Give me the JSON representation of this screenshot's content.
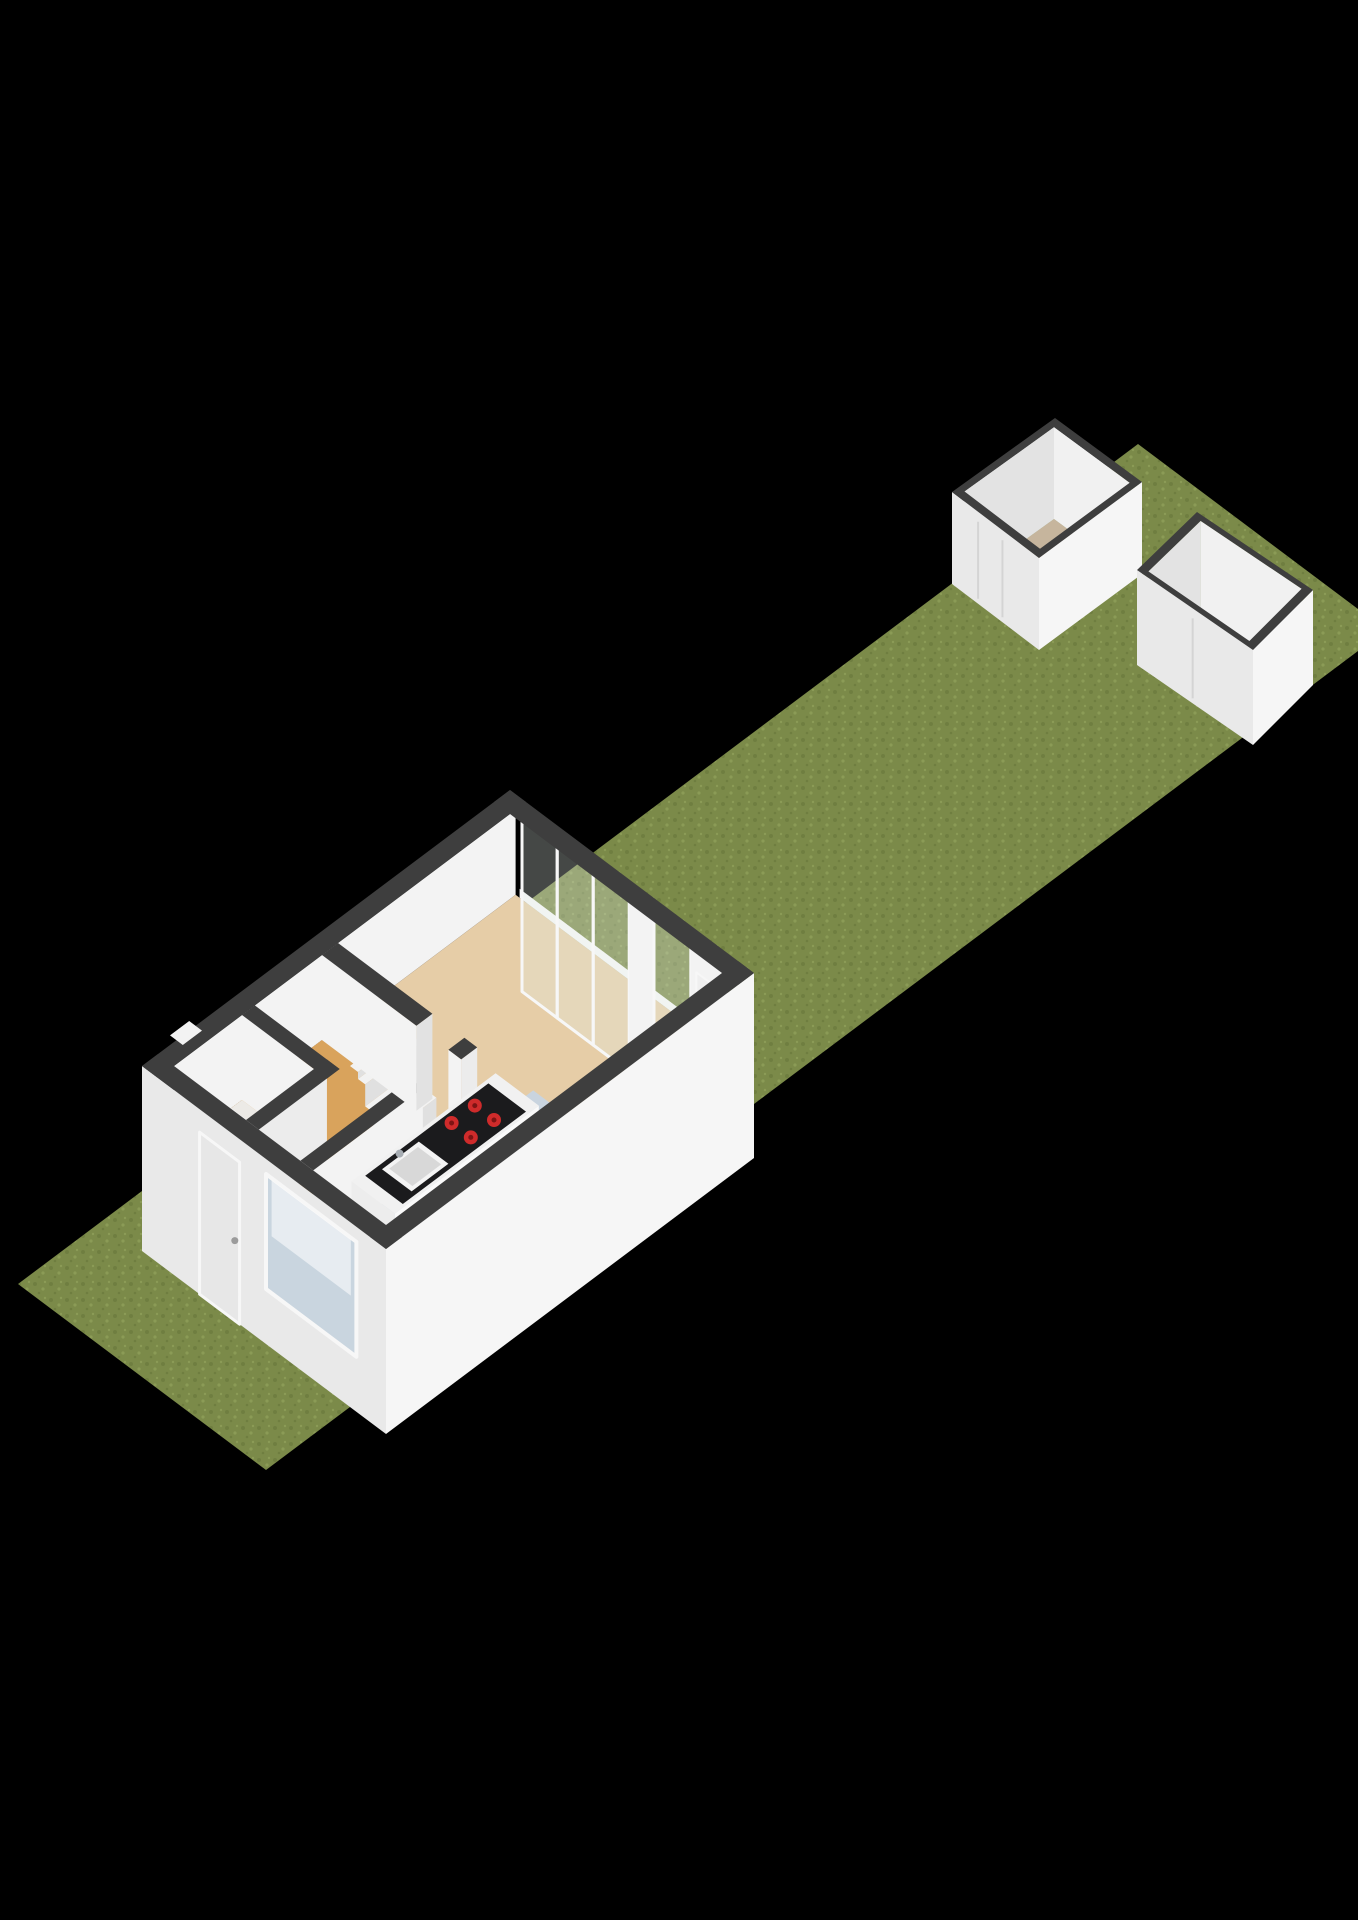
{
  "colors": {
    "background": "#000000",
    "grassBase": "#7b8a49",
    "grassDot1": "#6f7e40",
    "grassDot2": "#8b9b56",
    "cap": "#3e3e3e",
    "extSW": "#e9e9e9",
    "extSE": "#f6f6f6",
    "innerBright": "#f3f3f3",
    "innerMid": "#ececec",
    "innerShade": "#e2e2e2",
    "floorLiving": "#e6cda7",
    "floorHall": "#d9a35c",
    "floorToilet": "#eceae6",
    "floorKitchen": "#c9d4df",
    "tread": "#f2f2f2",
    "riser": "#e0e0e0",
    "toiletFront": "#e6e6e6",
    "toiletTop": "#f6f6f6",
    "toiletRed": "#992020",
    "counterEnd": "#ededed",
    "counterFront": "#fafafa",
    "counterTop": "#f1f1f1",
    "counterBlack": "#1b1b1d",
    "sinkOuter": "#f4f4f4",
    "sinkInner": "#d8d8d8",
    "faucet": "#a7adb3",
    "burner": "#cf2b2b",
    "burnerRing": "#7e1414",
    "glass": "rgba(228,238,233,0.30)",
    "frame": "#f7f7f7",
    "door": "#e7e7e7",
    "doorBack": "#efefef",
    "handle": "#9b9b9b",
    "windowBlue": "#c9d5df",
    "windowWhite": "rgba(255,255,255,0.55)",
    "shedFloor": "#c6b59d",
    "shedInnerNW": "#e3e3e3",
    "shedInnerNE": "#f1f1f1",
    "shedOuterSW": "#e9e9e9",
    "shedOuterSE": "#f6f6f6",
    "shedDoorSeam": "#d4d4d4"
  },
  "scene": {
    "width": 1358,
    "height": 1920,
    "proj": {
      "x0": 18,
      "y0": 1284,
      "k": 0.8,
      "m": 0.6
    },
    "items": [
      {
        "t": "poly",
        "pts": [
          [
            18,
            1284
          ],
          [
            1138,
            444
          ],
          [
            1386,
            630
          ],
          [
            266,
            1470
          ]
        ],
        "f": "url:grass",
        "n": "garden-plot",
        "i": false
      },
      {
        "t": "shed",
        "cap": [
          [
            1055,
            418
          ],
          [
            1142,
            482
          ],
          [
            1039,
            558
          ],
          [
            952,
            492
          ]
        ],
        "drop": 92,
        "doors": [
          0.3,
          0.58
        ],
        "n": "shed-1",
        "i": true
      },
      {
        "t": "shed",
        "cap": [
          [
            1197,
            512
          ],
          [
            1313,
            590
          ],
          [
            1253,
            650
          ],
          [
            1137,
            570
          ]
        ],
        "drop": 95,
        "doors": [
          0.48
        ],
        "n": "shed-2",
        "i": true
      },
      {
        "t": "bface",
        "b": 70,
        "a": [
          125,
          552
        ],
        "h": [
          100,
          185
        ],
        "f": "innerBright",
        "n": "wall-nw-inner"
      },
      {
        "t": "hquad",
        "a": [
          125,
          552
        ],
        "b": [
          70,
          335
        ],
        "h": 100,
        "f": "floorLiving",
        "n": "room-living",
        "i": true
      },
      {
        "t": "hquad",
        "a": [
          125,
          310
        ],
        "b": [
          70,
          228
        ],
        "h": 100,
        "f": "floorHall",
        "n": "room-hall",
        "i": true
      },
      {
        "t": "hquad",
        "a": [
          125,
          210
        ],
        "b": [
          70,
          160
        ],
        "h": 100,
        "f": "floorToilet",
        "n": "room-toilet",
        "i": true
      },
      {
        "t": "hquad",
        "a": [
          125,
          400
        ],
        "b": [
          244,
          335
        ],
        "h": 100,
        "f": "floorKitchen",
        "n": "room-kitchen",
        "i": true
      },
      {
        "t": "hquad",
        "a": [
          262,
          310
        ],
        "b": [
          228,
          244
        ],
        "h": 100,
        "f": "floorHall",
        "n": "doorway-threshold"
      },
      {
        "t": "hquad",
        "a": [
          235,
          305
        ],
        "b": [
          180,
          190
        ],
        "h": 185,
        "f": "tread",
        "n": "stair-tread"
      },
      {
        "t": "bface",
        "b": 190,
        "a": [
          235,
          305
        ],
        "h": [
          178,
          185
        ],
        "f": "riser",
        "n": "stair-riser"
      },
      {
        "t": "hquad",
        "a": [
          235,
          305
        ],
        "b": [
          190,
          199
        ],
        "h": 178,
        "f": "tread",
        "n": "stair-tread"
      },
      {
        "t": "bface",
        "b": 199,
        "a": [
          235,
          305
        ],
        "h": [
          156,
          178
        ],
        "f": "riser",
        "n": "stair-riser"
      },
      {
        "t": "hquad",
        "a": [
          235,
          305
        ],
        "b": [
          199,
          209
        ],
        "h": 156,
        "f": "tread",
        "n": "stair-tread"
      },
      {
        "t": "bface",
        "b": 209,
        "a": [
          235,
          305
        ],
        "h": [
          134,
          156
        ],
        "f": "riser",
        "n": "stair-riser"
      },
      {
        "t": "hquad",
        "a": [
          235,
          305
        ],
        "b": [
          209,
          218
        ],
        "h": 134,
        "f": "tread",
        "n": "stair-tread"
      },
      {
        "t": "bface",
        "b": 218,
        "a": [
          235,
          305
        ],
        "h": [
          112,
          134
        ],
        "f": "riser",
        "n": "stair-riser"
      },
      {
        "t": "hquad",
        "a": [
          235,
          305
        ],
        "b": [
          218,
          228
        ],
        "h": 112,
        "f": "tread",
        "n": "stair-tread"
      },
      {
        "t": "bface",
        "b": 228,
        "a": [
          235,
          305
        ],
        "h": [
          100,
          112
        ],
        "f": "riser",
        "n": "stair-riser"
      },
      {
        "t": "aface",
        "a": 132,
        "b": [
          98,
          142
        ],
        "h": [
          100,
          134
        ],
        "f": "innerMid",
        "n": "toilet-fixture"
      },
      {
        "t": "bface",
        "b": 142,
        "a": [
          132,
          168
        ],
        "h": [
          100,
          134
        ],
        "f": "toiletFront",
        "n": "toilet-fixture"
      },
      {
        "t": "hquad",
        "a": [
          132,
          168
        ],
        "b": [
          98,
          142
        ],
        "h": 134,
        "f": "toiletTop",
        "n": "toilet-fixture"
      },
      {
        "t": "hquad",
        "a": [
          134,
          143
        ],
        "b": [
          102,
          138
        ],
        "h": 134,
        "f": "toiletRed",
        "n": "toilet-cistern"
      },
      {
        "t": "aface",
        "a": 210,
        "b": [
          70,
          176
        ],
        "h": [
          100,
          185
        ],
        "f": "innerBright",
        "n": "wall-toilet"
      },
      {
        "t": "hquad",
        "a": [
          210,
          226
        ],
        "b": [
          70,
          176
        ],
        "h": 185,
        "f": "cap",
        "n": "wall-cap"
      },
      {
        "t": "bface",
        "b": 176,
        "a": [
          125,
          210
        ],
        "h": [
          100,
          185
        ],
        "f": "innerMid",
        "n": "wall-toilet"
      },
      {
        "t": "hquad",
        "a": [
          125,
          226
        ],
        "b": [
          160,
          176
        ],
        "h": 185,
        "f": "cap",
        "n": "wall-cap"
      },
      {
        "t": "bface",
        "b": 244,
        "a": [
          125,
          262
        ],
        "h": [
          100,
          185
        ],
        "f": "innerBright",
        "n": "wall-kitchen"
      },
      {
        "t": "hquad",
        "a": [
          125,
          262
        ],
        "b": [
          228,
          244
        ],
        "h": 185,
        "f": "cap",
        "n": "wall-cap"
      },
      {
        "t": "aface",
        "a": 310,
        "b": [
          70,
          188
        ],
        "h": [
          100,
          185
        ],
        "f": "innerBright",
        "n": "wall-stairs"
      },
      {
        "t": "bface",
        "b": 188,
        "a": [
          310,
          330
        ],
        "h": [
          100,
          185
        ],
        "f": "innerShade",
        "n": "wall-stairs-end"
      },
      {
        "t": "hquad",
        "a": [
          310,
          330
        ],
        "b": [
          70,
          188
        ],
        "h": 185,
        "f": "cap",
        "n": "wall-cap"
      },
      {
        "t": "aface",
        "a": 310,
        "b": [
          228,
          244
        ],
        "h": [
          100,
          185
        ],
        "f": "innerBright",
        "n": "wall-pillar"
      },
      {
        "t": "bface",
        "b": 244,
        "a": [
          310,
          330
        ],
        "h": [
          100,
          185
        ],
        "f": "innerMid",
        "n": "wall-pillar"
      },
      {
        "t": "hquad",
        "a": [
          310,
          330
        ],
        "b": [
          228,
          244
        ],
        "h": 185,
        "f": "cap",
        "n": "wall-cap"
      },
      {
        "t": "aface",
        "a": 165,
        "b": [
          252,
          306
        ],
        "h": [
          100,
          155
        ],
        "f": "counterEnd",
        "n": "kitchen-counter"
      },
      {
        "t": "bface",
        "b": 306,
        "a": [
          165,
          345
        ],
        "h": [
          100,
          155
        ],
        "f": "counterFront",
        "n": "kitchen-counter"
      },
      {
        "t": "hquad",
        "a": [
          165,
          345
        ],
        "b": [
          252,
          306
        ],
        "h": 155,
        "f": "counterTop",
        "n": "kitchen-counter",
        "i": true
      },
      {
        "t": "hquad",
        "a": [
          178,
          332
        ],
        "b": [
          256,
          303
        ],
        "h": 155,
        "f": "counterBlack",
        "n": "counter-black-top"
      },
      {
        "t": "hquad",
        "a": [
          194,
          240
        ],
        "b": [
          261,
          298
        ],
        "h": 155,
        "f": "sinkOuter",
        "n": "kitchen-sink"
      },
      {
        "t": "hquad",
        "a": [
          199,
          235
        ],
        "b": [
          265,
          294
        ],
        "h": 155,
        "f": "sinkInner",
        "n": "kitchen-sink-basin"
      },
      {
        "t": "circle",
        "at": [
          218,
          259,
          155
        ],
        "r": 4,
        "f": "faucet",
        "n": "kitchen-faucet"
      },
      {
        "t": "circle",
        "at": [
          276,
          266,
          155
        ],
        "r": 7,
        "f": "burner",
        "n": "cooktop-burner"
      },
      {
        "t": "circle",
        "at": [
          276,
          290,
          155
        ],
        "r": 7,
        "f": "burner",
        "n": "cooktop-burner"
      },
      {
        "t": "circle",
        "at": [
          305,
          266,
          155
        ],
        "r": 7,
        "f": "burner",
        "n": "cooktop-burner"
      },
      {
        "t": "circle",
        "at": [
          305,
          290,
          155
        ],
        "r": 7,
        "f": "burner",
        "n": "cooktop-burner"
      },
      {
        "t": "circle",
        "at": [
          276,
          266,
          155
        ],
        "r": 2.5,
        "f": "burnerRing",
        "n": "burner-center"
      },
      {
        "t": "circle",
        "at": [
          276,
          290,
          155
        ],
        "r": 2.5,
        "f": "burnerRing",
        "n": "burner-center"
      },
      {
        "t": "circle",
        "at": [
          305,
          266,
          155
        ],
        "r": 2.5,
        "f": "burnerRing",
        "n": "burner-center"
      },
      {
        "t": "circle",
        "at": [
          305,
          290,
          155
        ],
        "r": 2.5,
        "f": "burnerRing",
        "n": "burner-center"
      },
      {
        "t": "aface",
        "a": 552,
        "b": [
          75,
          335
        ],
        "h": [
          100,
          109
        ],
        "f": "frame",
        "n": "window-sill"
      },
      {
        "t": "aface",
        "a": 552,
        "b": [
          78,
          122
        ],
        "h": [
          8,
          183
        ],
        "f": "glass",
        "s": "frame",
        "w": 3,
        "n": "glass-panel"
      },
      {
        "t": "aface",
        "a": 552,
        "b": [
          122,
          167
        ],
        "h": [
          8,
          183
        ],
        "f": "glass",
        "s": "frame",
        "w": 3,
        "n": "glass-panel"
      },
      {
        "t": "aface",
        "a": 552,
        "b": [
          167,
          212
        ],
        "h": [
          8,
          183
        ],
        "f": "glass",
        "s": "frame",
        "w": 3,
        "n": "glass-panel"
      },
      {
        "t": "aface",
        "a": 552,
        "b": [
          212,
          243
        ],
        "h": [
          8,
          185
        ],
        "f": "innerBright",
        "n": "wall-ne-pillar"
      },
      {
        "t": "aface",
        "a": 552,
        "b": [
          243,
          289
        ],
        "h": [
          8,
          183
        ],
        "f": "glass",
        "s": "frame",
        "w": 3,
        "n": "glass-door",
        "i": true
      },
      {
        "t": "aface",
        "a": 552,
        "b": [
          289,
          335
        ],
        "h": [
          8,
          185
        ],
        "f": "innerBright",
        "n": "wall-ne-end"
      },
      {
        "t": "aface",
        "a": 552,
        "b": [
          296,
          325
        ],
        "h": [
          12,
          158
        ],
        "f": "doorBack",
        "s": "frame",
        "w": 2,
        "n": "back-door",
        "i": true
      },
      {
        "t": "aface",
        "a": 105,
        "b": [
          50,
          355
        ],
        "h": [
          0,
          185
        ],
        "f": "extSW",
        "n": "facade-sw"
      },
      {
        "t": "aface",
        "a": 105,
        "b": [
          122,
          172
        ],
        "h": [
          0,
          162
        ],
        "f": "door",
        "s": "frame",
        "w": 3,
        "n": "front-door",
        "i": true
      },
      {
        "t": "circle",
        "at": [
          105,
          166,
          80
        ],
        "r": 3.5,
        "f": "handle",
        "n": "door-handle"
      },
      {
        "t": "aface",
        "a": 105,
        "b": [
          205,
          318
        ],
        "h": [
          55,
          170
        ],
        "f": "windowBlue",
        "s": "frame",
        "w": 4,
        "n": "kitchen-window",
        "i": true
      },
      {
        "t": "aface",
        "a": 105,
        "b": [
          212,
          311
        ],
        "h": [
          112,
          168
        ],
        "f": "windowWhite",
        "n": "window-reflection"
      },
      {
        "t": "bface",
        "b": 355,
        "a": [
          105,
          565
        ],
        "h": [
          0,
          185
        ],
        "f": "extSE",
        "n": "facade-se"
      },
      {
        "t": "hquad",
        "a": [
          105,
          565
        ],
        "b": [
          50,
          70
        ],
        "h": 185,
        "f": "cap",
        "n": "wall-cap-nw"
      },
      {
        "t": "hquad",
        "a": [
          545,
          565
        ],
        "b": [
          50,
          355
        ],
        "h": 185,
        "f": "cap",
        "n": "wall-cap-ne"
      },
      {
        "t": "hquad",
        "a": [
          105,
          565
        ],
        "b": [
          335,
          355
        ],
        "h": 185,
        "f": "cap",
        "n": "wall-cap-se"
      },
      {
        "t": "hquad",
        "a": [
          105,
          125
        ],
        "b": [
          50,
          355
        ],
        "h": 185,
        "f": "cap",
        "n": "wall-cap-sw"
      },
      {
        "t": "hquad",
        "a": [
          148,
          172
        ],
        "b": [
          42,
          58
        ],
        "h": 185,
        "f": "innerBright",
        "n": "nw-vent"
      }
    ]
  }
}
